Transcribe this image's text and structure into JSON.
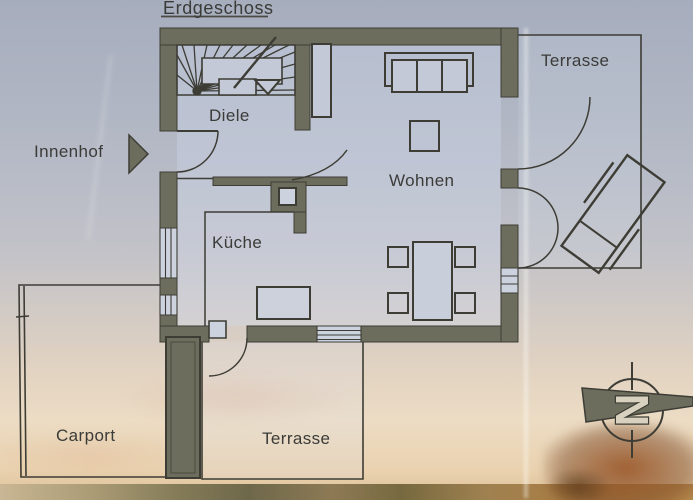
{
  "title": "Erdgeschoss",
  "floor_plan": {
    "rooms": {
      "diele": "Diele",
      "kueche": "Küche",
      "wohnen": "Wohnen"
    },
    "outdoor": {
      "terrace_top": "Terrasse",
      "terrace_bottom": "Terrasse",
      "carport": "Carport",
      "innenhof": "Innenhof"
    },
    "compass": {
      "north_letter": "N"
    }
  },
  "colors": {
    "wall_fill": "#6d6d5e",
    "line": "#3d3d35",
    "text": "#3b3b38",
    "window_fill": "#ccd2de"
  }
}
